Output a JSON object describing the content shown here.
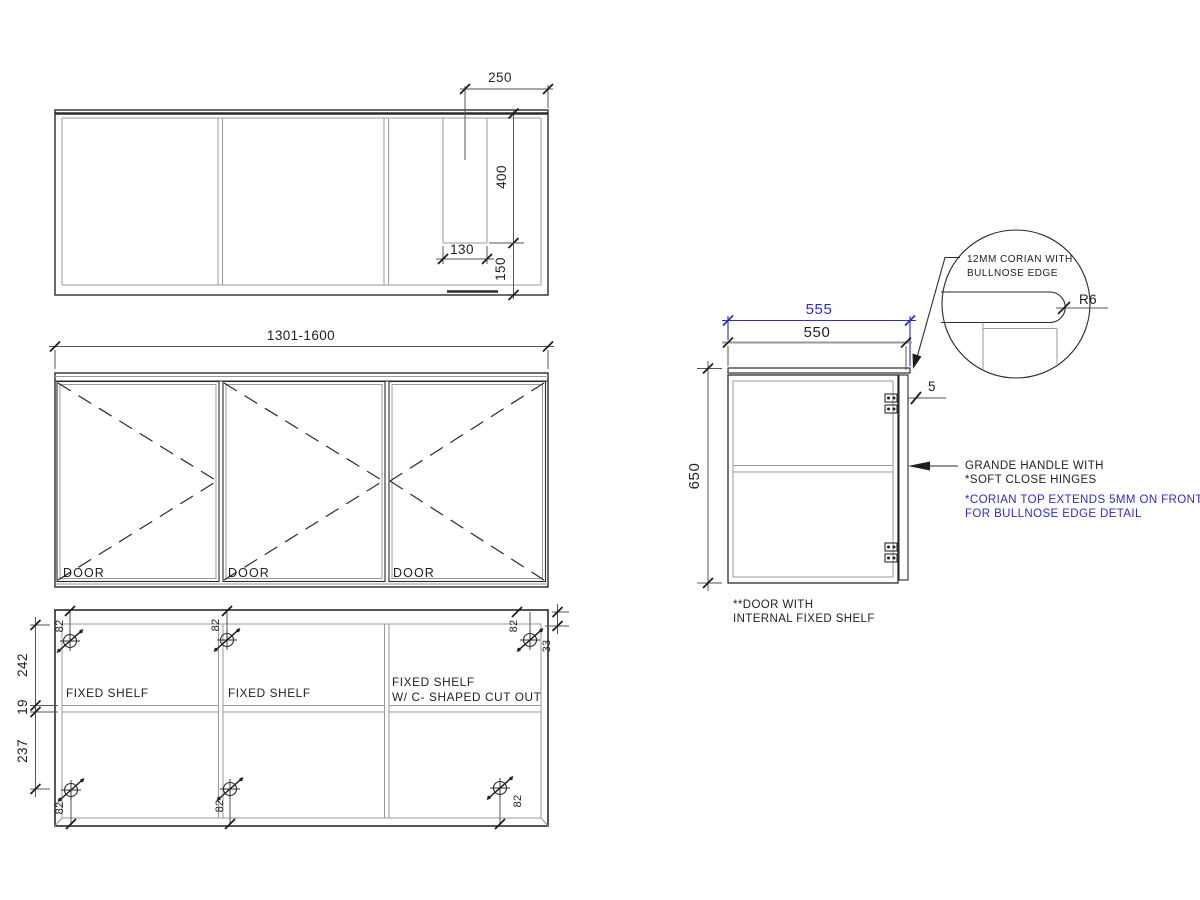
{
  "colors": {
    "line": "#2b2b2b",
    "secondary": "#9a9a9a",
    "accent_blue": "#2b2bd0"
  },
  "top_view": {
    "dim_250": "250",
    "dim_400": "400",
    "dim_130": "130",
    "dim_150": "150"
  },
  "front_view": {
    "dim_width": "1301-1600",
    "door1": "DOOR",
    "door2": "DOOR",
    "door3": "DOOR"
  },
  "internal_view": {
    "dim_242": "242",
    "dim_19": "19",
    "dim_237": "237",
    "dim_33": "33",
    "hinge_labels": [
      "82",
      "82",
      "82",
      "82",
      "82",
      "82"
    ],
    "shelf1": "FIXED SHELF",
    "shelf2": "FIXED SHELF",
    "shelf3_line1": "FIXED SHELF",
    "shelf3_line2": "W/ C- SHAPED CUT OUT"
  },
  "side_view": {
    "dim_555": "555",
    "dim_550": "550",
    "dim_650": "650",
    "dim_5": "5",
    "note_handle_line1": "GRANDE HANDLE WITH",
    "note_handle_line2": "*SOFT CLOSE HINGES",
    "note_corian_line1": "*CORIAN TOP EXTENDS 5MM ON FRONT",
    "note_corian_line2": "FOR BULLNOSE EDGE DETAIL",
    "note_door_line1": "**DOOR WITH",
    "note_door_line2": "INTERNAL FIXED SHELF"
  },
  "detail": {
    "line1": "12MM CORIAN WITH",
    "line2": "BULLNOSE EDGE",
    "radius": "R6"
  }
}
